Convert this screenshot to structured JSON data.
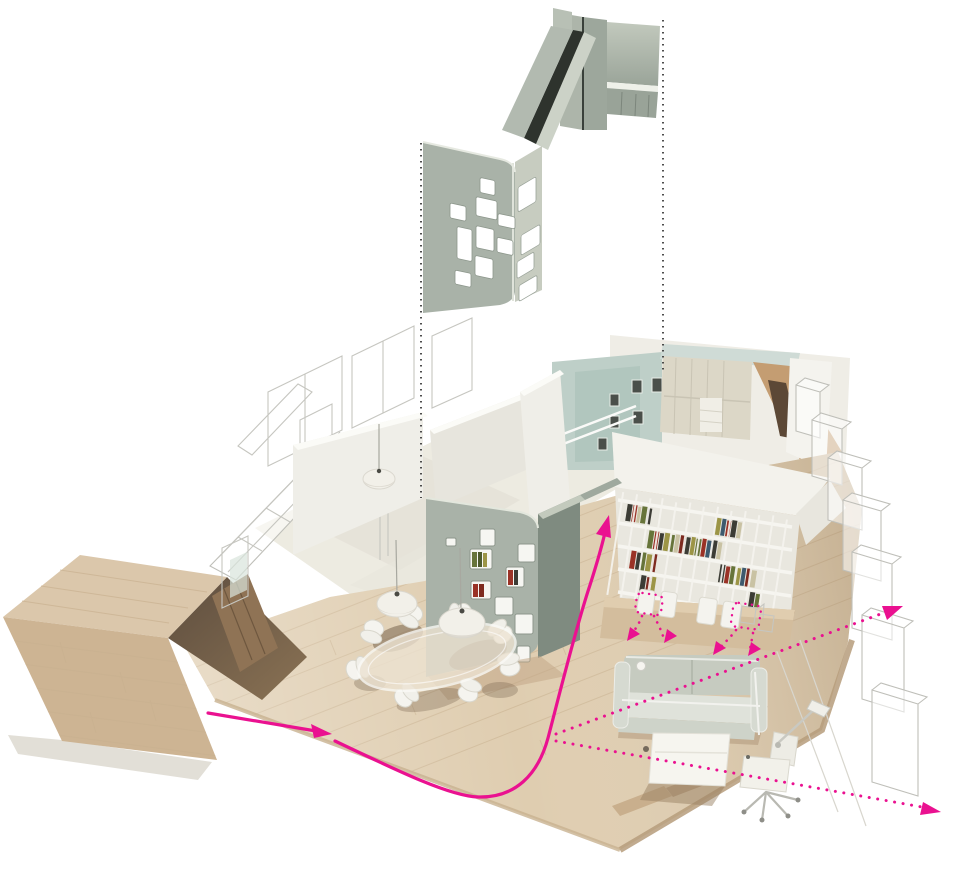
{
  "meta": {
    "type": "architectural-exploded-axonometric-diagram",
    "description": "Cutaway axonometric rendering of an apartment interior with a perforated partition wall exploded upward, dotted leader lines, and magenta circulation and sightline arrows"
  },
  "colors": {
    "background": "#FFFFFF",
    "accent": "#EA1190",
    "leader": "#3A3A3A",
    "sage": "#A9B2A8",
    "sage_dark": "#7F8B80",
    "sage_light": "#C9CFC3",
    "sage_gap": "#2E332D",
    "wood": "#DFCDB0",
    "wood_dark": "#C49D72",
    "wood_shadow": "#7A6550",
    "wall_white": "#F2F1EB",
    "teal": "#BECFC8",
    "glass": "#CCDAD5",
    "wireframe": "#C6C6C0",
    "sofa": "#C6CBC0",
    "book_red": "#9A3226",
    "book_green": "#67743A",
    "book_olive": "#9C9546",
    "book_dark": "#3C3C35",
    "book_cream": "#C9C2A3"
  },
  "annotations": {
    "leader_lines": {
      "style": "dotted",
      "count": 2,
      "orientation": "vertical"
    },
    "entry_arrow": {
      "style": "solid",
      "from": "storage-volume-opening",
      "direction": "right"
    },
    "circulation_curve": {
      "style": "solid",
      "from": "dining-area",
      "to": "bookshelf-wall",
      "arrowhead": "up"
    },
    "sightline_upper": {
      "style": "dotted",
      "direction": "up-right"
    },
    "sightline_lower": {
      "style": "dotted",
      "direction": "down-right"
    },
    "furniture_move_arrows": {
      "style": "dotted",
      "count": 4,
      "direction": "down-left"
    },
    "furniture_loops": {
      "style": "dotted",
      "count": 2,
      "shape": "rounded-rectangle"
    }
  },
  "scene": {
    "exploded_element": "perforated-partition-wall-assembly",
    "elements": [
      {
        "name": "exploded-wall-assembly",
        "description": "sage green perforated wall lifted above the model"
      },
      {
        "name": "leader-lines",
        "description": "two vertical dotted lines locating the exploded wall"
      },
      {
        "name": "wood-floor",
        "description": "oak plank floor plate"
      },
      {
        "name": "storage-volume",
        "description": "large wooden box with dark entry opening at left"
      },
      {
        "name": "window-wall-wireframe",
        "description": "outlined glazing wall at left"
      },
      {
        "name": "room-wireframes",
        "description": "outline-only walls of adjacent rooms"
      },
      {
        "name": "partition-wall-in-place",
        "description": "sage perforated wall with book niches"
      },
      {
        "name": "bookshelf-wall",
        "description": "white shelving wall filled with books"
      },
      {
        "name": "desk-counter",
        "description": "desk with white chairs under bookshelf"
      },
      {
        "name": "dining-table",
        "description": "oval glass dining table with shell chairs"
      },
      {
        "name": "pendant-lamps",
        "description": "three white pendant lamps"
      },
      {
        "name": "sofa",
        "description": "grey two-seat sofa"
      },
      {
        "name": "coffee-table",
        "description": "low white table"
      },
      {
        "name": "desk-chair",
        "description": "white task chair with lamp"
      },
      {
        "name": "kitchen-cabinets",
        "description": "cream cabinet wall with glass clerestory"
      },
      {
        "name": "teal-niche-wall",
        "description": "teal wall with small framed pictures"
      },
      {
        "name": "shelf-wireframes",
        "description": "outline boxes along right edge"
      }
    ]
  }
}
